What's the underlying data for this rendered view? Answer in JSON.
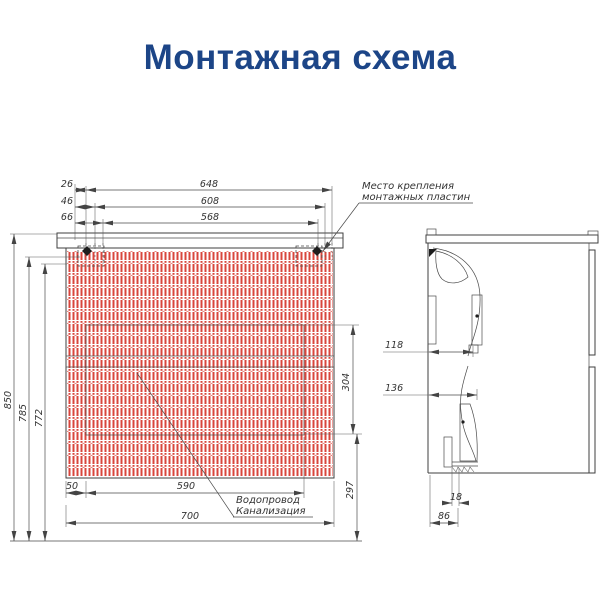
{
  "title": "Монтажная схема",
  "colors": {
    "title_blue": "#1c4587",
    "hatch_red": "#d8463c",
    "line_gray": "#3f3f3f"
  },
  "front_view": {
    "top_offset_dims": [
      "26",
      "46",
      "66"
    ],
    "top_width_dims": [
      "648",
      "608",
      "568"
    ],
    "height_dims": [
      "850",
      "785",
      "772"
    ],
    "right_dims": {
      "recess_height": "304",
      "floor_clearance": "297"
    },
    "bottom_dims": {
      "edge_offset": "50",
      "drawer_width": "590",
      "total_width": "700"
    },
    "mounting_label": {
      "line1": "Место крепления",
      "line2": "монтажных пластин"
    },
    "plumbing_label": {
      "line1": "Водопровод",
      "line2": "Канализация"
    }
  },
  "side_view": {
    "dims": {
      "upper_bracket_depth": "118",
      "lower_bracket_depth": "136",
      "rail_thickness": "18",
      "rail_offset": "86"
    }
  }
}
